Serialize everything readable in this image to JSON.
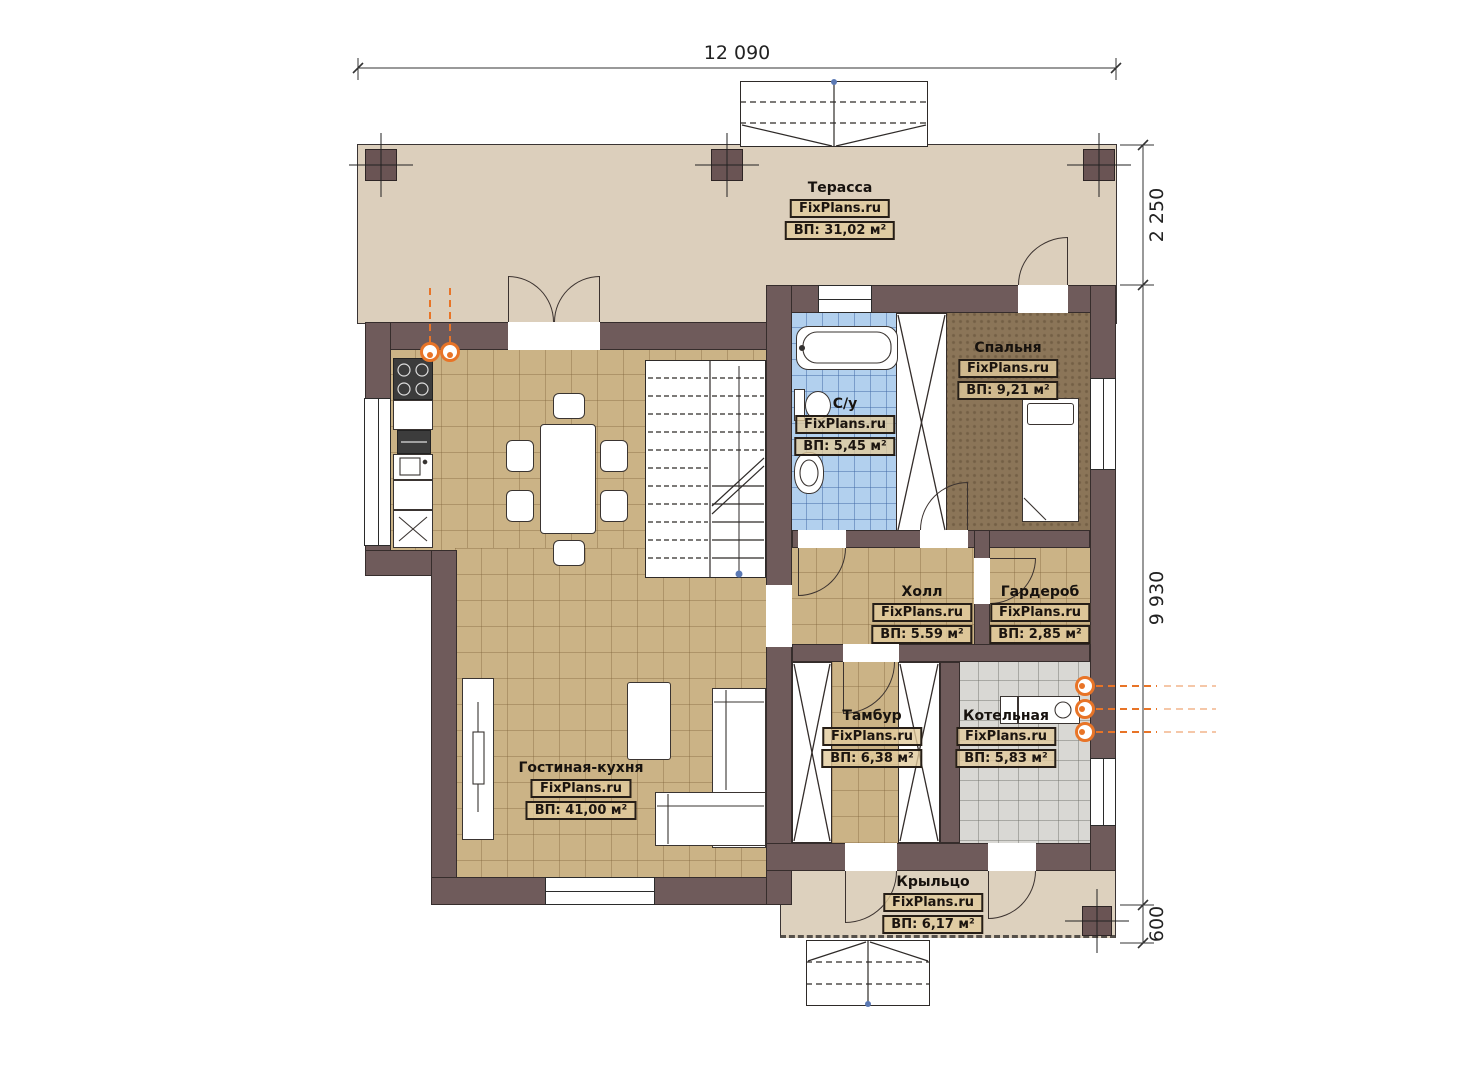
{
  "brand": "FixPlans.ru",
  "dimensions": {
    "top_width": "12 090",
    "right_terrace_depth": "2 250",
    "right_house_depth": "9 930",
    "right_porch_depth": "600"
  },
  "rooms": {
    "terrace": {
      "name": "Терасса",
      "brand": "FixPlans.ru",
      "area": "ВП: 31,02 м²"
    },
    "bedroom": {
      "name": "Спальня",
      "brand": "FixPlans.ru",
      "area": "ВП: 9,21 м²"
    },
    "bathroom": {
      "name": "С/у",
      "brand": "FixPlans.ru",
      "area": "ВП: 5,45 м²"
    },
    "hall": {
      "name": "Холл",
      "brand": "FixPlans.ru",
      "area": "ВП: 5.59 м²"
    },
    "wardrobe": {
      "name": "Гардероб",
      "brand": "FixPlans.ru",
      "area": "ВП: 2,85 м²"
    },
    "vestibule": {
      "name": "Тамбур",
      "brand": "FixPlans.ru",
      "area": "ВП: 6,38 м²"
    },
    "boiler": {
      "name": "Котельная",
      "brand": "FixPlans.ru",
      "area": "ВП: 5,83 м²"
    },
    "living": {
      "name": "Гостиная-кухня",
      "brand": "FixPlans.ru",
      "area": "ВП: 41,00 м²"
    },
    "porch": {
      "name": "Крыльцо",
      "brand": "FixPlans.ru",
      "area": "ВП: 6,17 м²"
    }
  },
  "colors": {
    "wall": "#6f5b5b",
    "terrace_floor": "#dccfbc",
    "tile_tan": "#cbb386",
    "tile_blue": "#b2d0ee",
    "tile_gray": "#d9d8d4",
    "bedroom_floor": "#8b7558",
    "utility_accent": "#e87427",
    "marker_blue": "#5b79b4"
  }
}
